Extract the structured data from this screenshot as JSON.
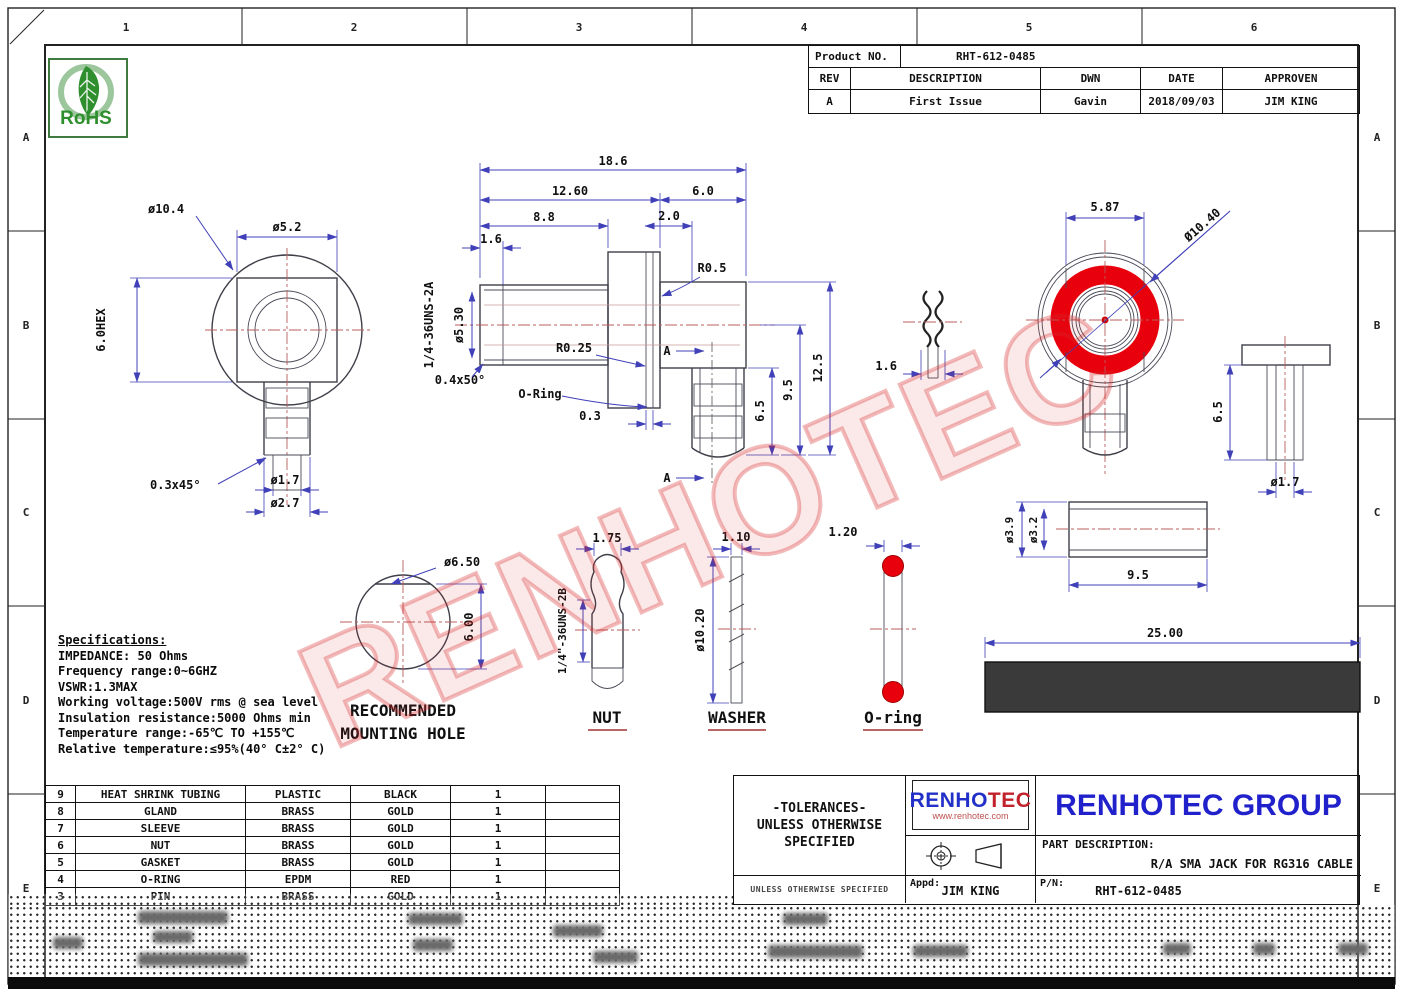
{
  "frame": {
    "columns": [
      "1",
      "2",
      "3",
      "4",
      "5",
      "6"
    ],
    "rows": [
      "A",
      "B",
      "C",
      "D",
      "E"
    ]
  },
  "rohs_label": "RoHS",
  "watermark_text": "RENHOTEC",
  "revision_table": {
    "product_no_label": "Product NO.",
    "product_no": "RHT-612-0485",
    "headers": {
      "rev": "REV",
      "description": "DESCRIPTION",
      "dwn": "DWN",
      "date": "DATE",
      "approven": "APPROVEN"
    },
    "row": {
      "rev": "A",
      "description": "First Issue",
      "dwn": "Gavin",
      "date": "2018/09/03",
      "approven": "JIM KING"
    }
  },
  "specifications": {
    "title": "Specifications:",
    "lines": [
      "IMPEDANCE: 50 Ohms",
      "Frequency range:0~6GHZ",
      "VSWR:1.3MAX",
      "Working voltage:500V rms @ sea level",
      "Insulation resistance:5000 Ohms min",
      "Temperature range:-65℃ TO +155℃",
      "Relative temperature:≤95%(40° C±2° C)"
    ]
  },
  "parts_table": {
    "rows": [
      {
        "no": "9",
        "name": "HEAT SHRINK TUBING",
        "material": "PLASTIC",
        "color": "BLACK",
        "qty": "1"
      },
      {
        "no": "8",
        "name": "GLAND",
        "material": "BRASS",
        "color": "GOLD",
        "qty": "1"
      },
      {
        "no": "7",
        "name": "SLEEVE",
        "material": "BRASS",
        "color": "GOLD",
        "qty": "1"
      },
      {
        "no": "6",
        "name": "NUT",
        "material": "BRASS",
        "color": "GOLD",
        "qty": "1"
      },
      {
        "no": "5",
        "name": "GASKET",
        "material": "BRASS",
        "color": "GOLD",
        "qty": "1"
      },
      {
        "no": "4",
        "name": "O-RING",
        "material": "EPDM",
        "color": "RED",
        "qty": "1"
      },
      {
        "no": "3",
        "name": "PIN",
        "material": "BRASS",
        "color": "GOLD",
        "qty": "1"
      }
    ]
  },
  "title_block": {
    "tolerances_line1": "-TOLERANCES-",
    "tolerances_line2": "UNLESS OTHERWISE",
    "tolerances_line3": "SPECIFIED",
    "tolerances_footer": "UNLESS OTHERWISE SPECIFIED",
    "logo_text_blue": "RENHO",
    "logo_text_red": "TEC",
    "logo_url": "www.renhotec.com",
    "company": "RENHOTEC GROUP",
    "part_description_label": "PART DESCRIPTION:",
    "part_description": "R/A SMA JACK FOR RG316 CABLE",
    "appd_label": "Appd:",
    "appd": "JIM KING",
    "pn_label": "P/N:",
    "pn": "RHT-612-0485"
  },
  "views": {
    "rear": {
      "d_flange": "ø10.4",
      "d_body": "ø5.2",
      "hex": "6.0HEX",
      "chamfer": "0.3x45°",
      "d_pin": "ø1.7",
      "d_pin2": "ø2.7"
    },
    "side": {
      "total": "18.6",
      "seg1": "12.60",
      "seg2": "6.0",
      "seg3": "8.8",
      "seg4": "2.0",
      "seg5": "1.6",
      "thread": "1/4-36UNS-2A",
      "d_thread": "ø5.30",
      "r1": "R0.5",
      "r2": "R0.25",
      "chamfer": "0.4x50°",
      "oring_label": "O-Ring",
      "groove": "0.3",
      "h1": "6.5",
      "h2": "9.5",
      "h3": "12.5",
      "section_label": "A"
    },
    "gasket": {
      "dim": "1.6"
    },
    "front": {
      "flat": "5.87",
      "dia": "Ø10.40"
    },
    "pin": {
      "h": "6.5",
      "d": "ø1.7"
    },
    "mounting_hole": {
      "d": "ø6.50",
      "h": "6.00",
      "caption1": "RECOMMENDED",
      "caption2": "MOUNTING HOLE"
    },
    "nut": {
      "w": "1.75",
      "thread": "1/4\"-36UNS-2B",
      "caption": "NUT"
    },
    "washer": {
      "w": "1.10",
      "d": "ø10.20",
      "caption": "WASHER"
    },
    "oring": {
      "w": "1.20",
      "caption": "O-ring"
    },
    "sleeve": {
      "d1": "ø3.9",
      "d2": "ø3.2",
      "len": "9.5"
    },
    "tubing": {
      "len": "25.00"
    }
  },
  "colors": {
    "accent_red": "#e8000d",
    "dim_blue": "#4040b8",
    "centerline_red": "#b85c5c",
    "logo_blue": "#2230c8",
    "logo_red": "#c2222c",
    "company_blue": "#2121cc",
    "tubing_gray": "#3a3a3a",
    "nut_green": "#d6eed6"
  }
}
